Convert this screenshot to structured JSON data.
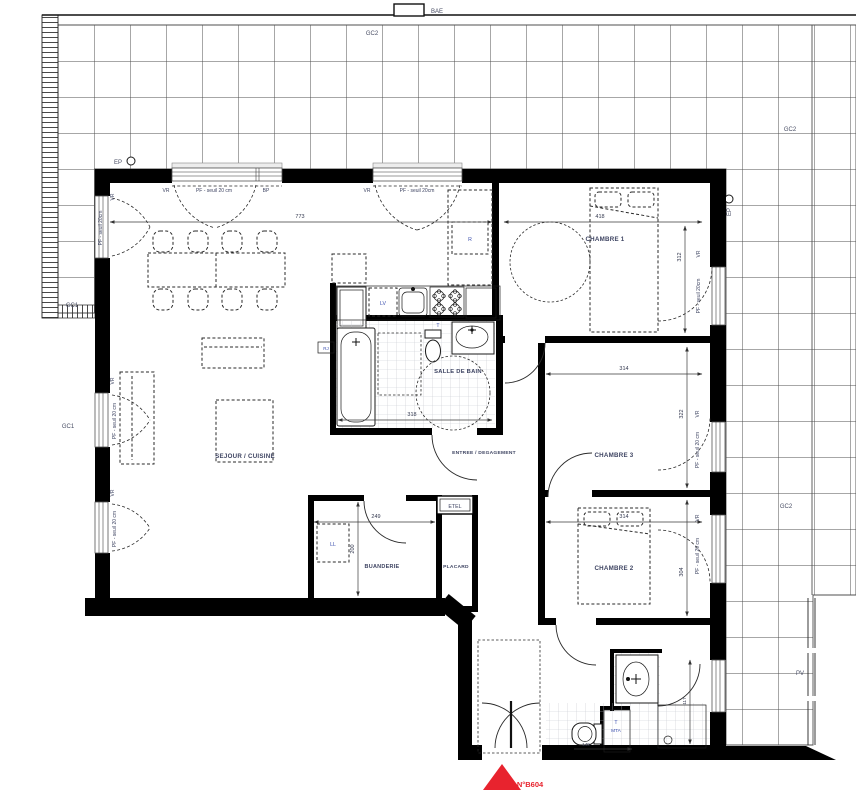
{
  "unit": {
    "number": "N°B604"
  },
  "rooms": {
    "sejour": "SEJOUR / CUISINE",
    "chambre1": "CHAMBRE 1",
    "chambre2": "CHAMBRE 2",
    "chambre3": "CHAMBRE 3",
    "salle_de_bain": "SALLE DE BAIN",
    "entree": "ENTREE / DEGAGEMENT",
    "buanderie": "BUANDERIE",
    "placard": "PLACARD"
  },
  "markers": {
    "bae": "BAE",
    "gc1": "GC1",
    "gc2": "GC2",
    "ep": "EP",
    "pv": "PV",
    "vr": "VR",
    "bp": "BP",
    "pf_seuil": "PF - seuil 20 cm",
    "pf_seuil_compact": "PF - seuil 20cm",
    "etel": "ETEL"
  },
  "equipment": {
    "fridge": "R",
    "dishwasher": "LV",
    "washer": "LL",
    "rj": "RJ",
    "t": "T",
    "mta": "MTA"
  },
  "dimensions": {
    "sejour_width": "773",
    "chambre1_width": "418",
    "chambre1_depth": "312",
    "chambre3_width": "314",
    "chambre3_depth": "322",
    "chambre2_width": "314",
    "chambre2_depth": "304",
    "salle_de_bain_width": "318",
    "buanderie_width": "249",
    "buanderie_depth": "200",
    "wc_width": "149",
    "salle_eau_depth": "117"
  },
  "colors": {
    "wall": "#000000",
    "accent_red": "#e8232e",
    "label_blue": "#3b4fae",
    "label_dark": "#3e4462",
    "tile_line": "#4f4f4f"
  }
}
